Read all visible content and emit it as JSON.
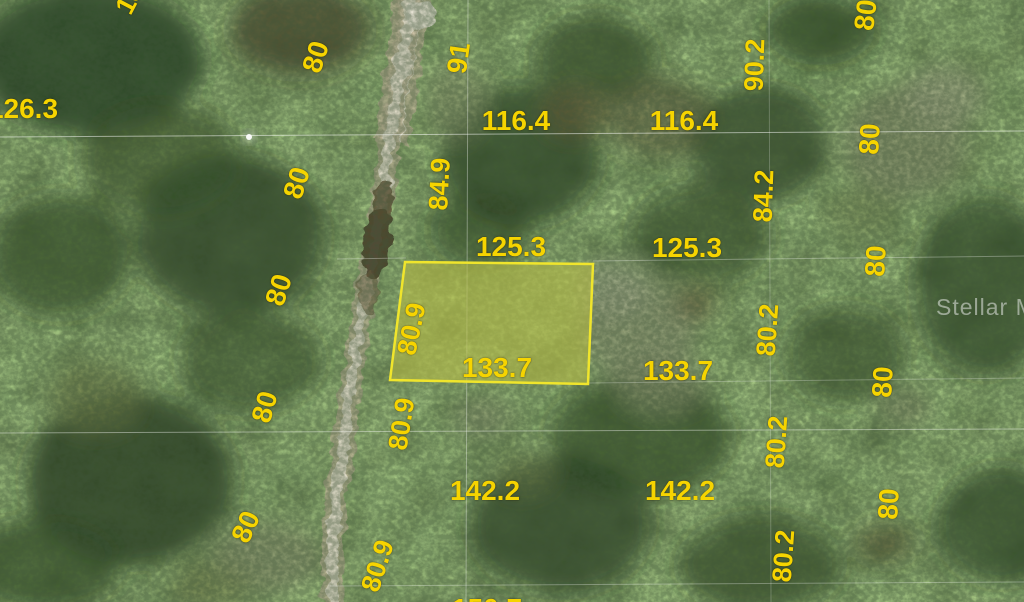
{
  "map": {
    "type": "aerial-parcel-plat-view",
    "watermark": {
      "text": "Stellar MLS",
      "x": 936,
      "y": 294
    },
    "colors": {
      "label_yellow": "#f6d400",
      "parcel_border": "#f0e52c",
      "parcel_fill": "rgba(230,232,70,0.32)",
      "road_core": "#efe8d7",
      "road_edge": "#c6ba9c",
      "forest_base": "#2f481f"
    },
    "highlighted_parcel": {
      "rear_width": "125.3",
      "front_width": "133.7",
      "side_depth": "80.9",
      "polygon": [
        [
          405,
          262
        ],
        [
          593,
          264
        ],
        [
          588,
          384
        ],
        [
          390,
          380
        ]
      ]
    },
    "dimension_labels": [
      {
        "text": "126.3",
        "x": 23,
        "y": 109,
        "rot": 0,
        "size": 28
      },
      {
        "text": "116.4",
        "x": 516,
        "y": 121,
        "rot": 0,
        "size": 28
      },
      {
        "text": "116.4",
        "x": 684,
        "y": 121,
        "rot": 0,
        "size": 28
      },
      {
        "text": "125.3",
        "x": 511,
        "y": 247,
        "rot": 0,
        "size": 28
      },
      {
        "text": "125.3",
        "x": 687,
        "y": 248,
        "rot": 0,
        "size": 28
      },
      {
        "text": "133.7",
        "x": 497,
        "y": 368,
        "rot": 0,
        "size": 28
      },
      {
        "text": "133.7",
        "x": 678,
        "y": 371,
        "rot": 0,
        "size": 28
      },
      {
        "text": "142.2",
        "x": 485,
        "y": 491,
        "rot": 0,
        "size": 28
      },
      {
        "text": "142.2",
        "x": 680,
        "y": 491,
        "rot": 0,
        "size": 28
      },
      {
        "text": "150.7",
        "x": 487,
        "y": 609,
        "rot": 0,
        "size": 28
      },
      {
        "text": "13",
        "x": 130,
        "y": -1,
        "rot": -62,
        "size": 27
      },
      {
        "text": "80",
        "x": 316,
        "y": 57,
        "rot": -72,
        "size": 28
      },
      {
        "text": "80",
        "x": 297,
        "y": 183,
        "rot": -72,
        "size": 28
      },
      {
        "text": "80",
        "x": 279,
        "y": 290,
        "rot": -72,
        "size": 28
      },
      {
        "text": "80",
        "x": 265,
        "y": 407,
        "rot": -74,
        "size": 28
      },
      {
        "text": "80",
        "x": 246,
        "y": 527,
        "rot": -66,
        "size": 28
      },
      {
        "text": "91",
        "x": 459,
        "y": 58,
        "rot": -82,
        "size": 28
      },
      {
        "text": "84.9",
        "x": 440,
        "y": 184,
        "rot": -87,
        "size": 27
      },
      {
        "text": "80.9",
        "x": 412,
        "y": 329,
        "rot": -78,
        "size": 27
      },
      {
        "text": "80.9",
        "x": 402,
        "y": 424,
        "rot": -81,
        "size": 27
      },
      {
        "text": "80.9",
        "x": 378,
        "y": 566,
        "rot": -72,
        "size": 27
      },
      {
        "text": "90.2",
        "x": 755,
        "y": 65,
        "rot": -88,
        "size": 27
      },
      {
        "text": "84.2",
        "x": 764,
        "y": 196,
        "rot": -88,
        "size": 27
      },
      {
        "text": "80.2",
        "x": 768,
        "y": 330,
        "rot": -86,
        "size": 27
      },
      {
        "text": "80.2",
        "x": 777,
        "y": 442,
        "rot": -86,
        "size": 27
      },
      {
        "text": "80.2",
        "x": 784,
        "y": 556,
        "rot": -86,
        "size": 27
      },
      {
        "text": "80",
        "x": 866,
        "y": 15,
        "rot": -83,
        "size": 28
      },
      {
        "text": "80",
        "x": 870,
        "y": 139,
        "rot": -87,
        "size": 28
      },
      {
        "text": "80",
        "x": 876,
        "y": 261,
        "rot": -87,
        "size": 28
      },
      {
        "text": "80",
        "x": 883,
        "y": 382,
        "rot": -87,
        "size": 28
      },
      {
        "text": "80",
        "x": 889,
        "y": 504,
        "rot": -87,
        "size": 28
      }
    ]
  }
}
